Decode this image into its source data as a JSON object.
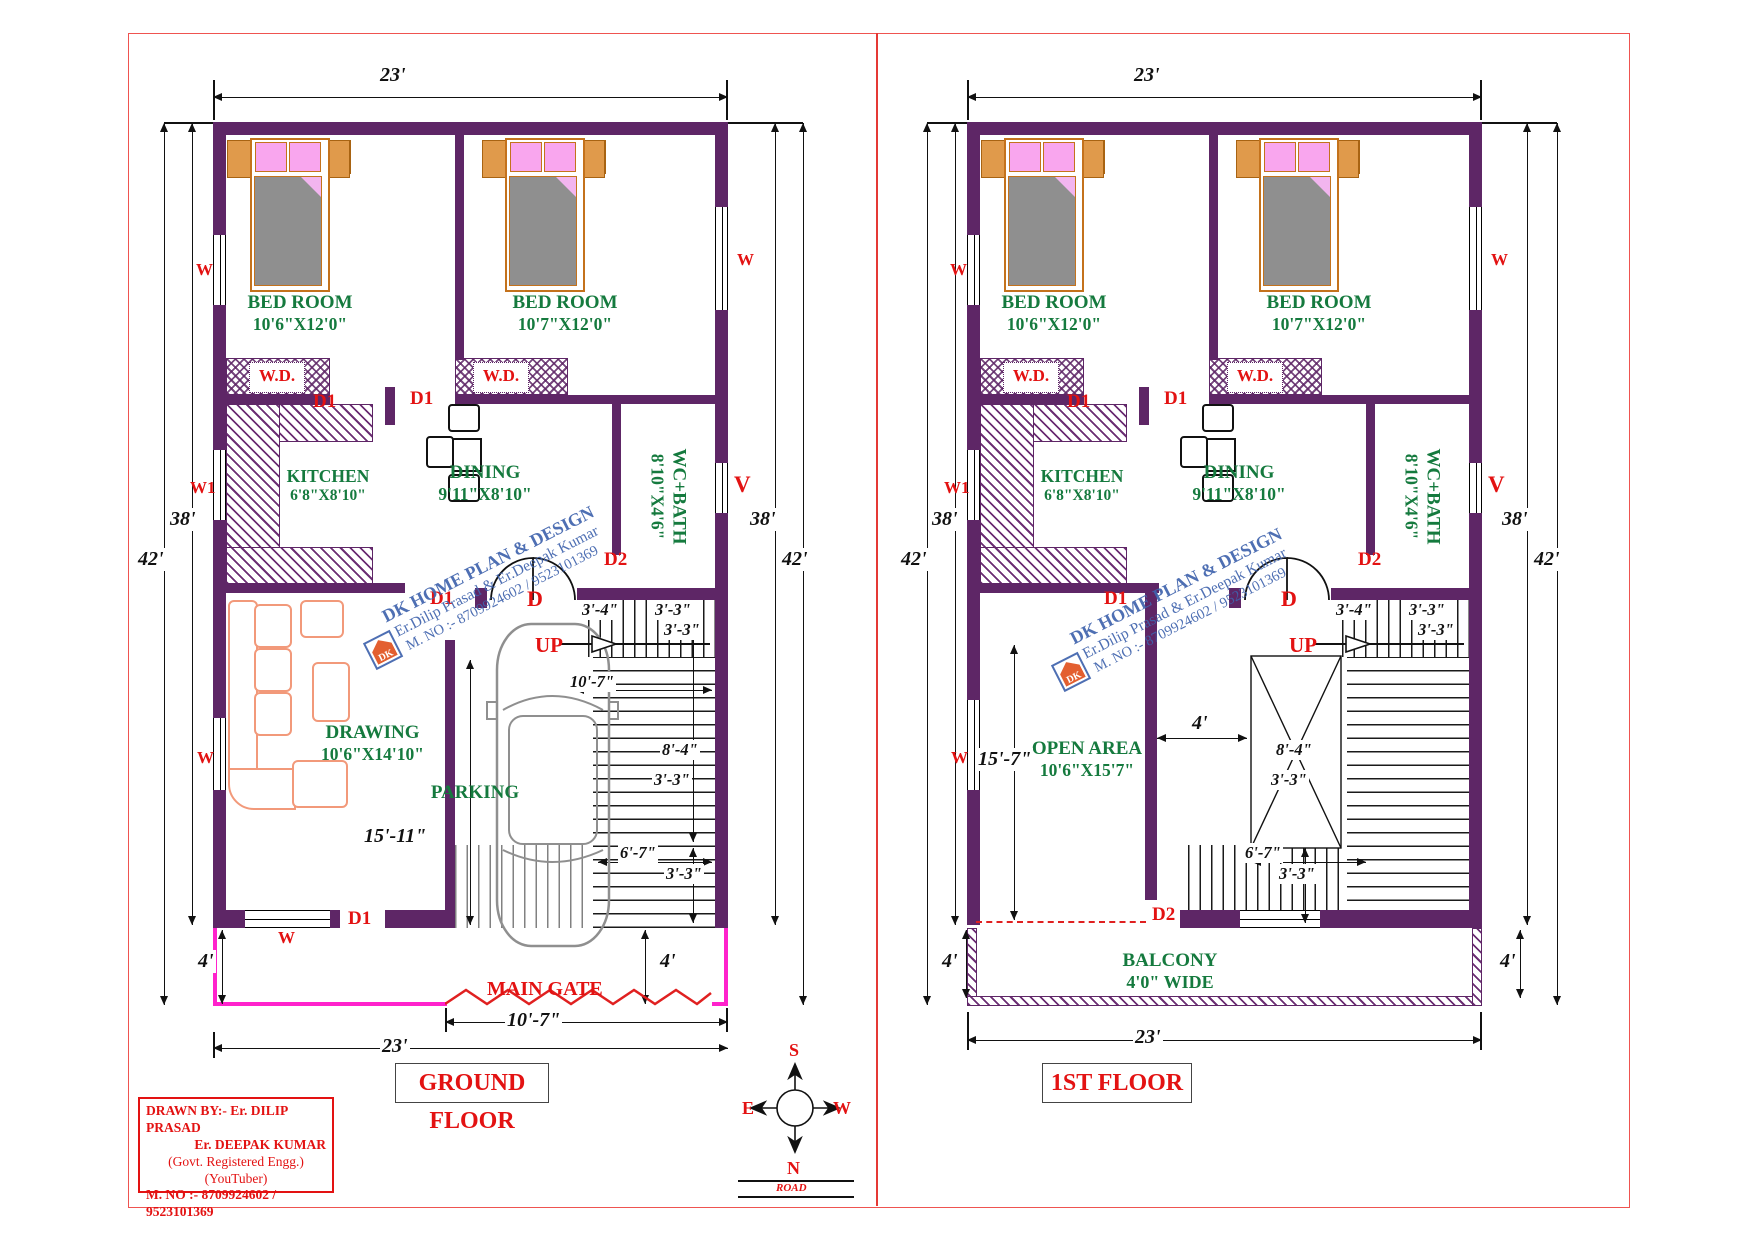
{
  "sheet": {
    "border_color": "#ef5350"
  },
  "compass": {
    "n": "N",
    "s": "S",
    "e": "E",
    "w": "W",
    "road": "ROAD"
  },
  "title_block": {
    "drawn_by": "DRAWN BY:- Er. DILIP PRASAD",
    "author2": "Er. DEEPAK KUMAR",
    "reg": "(Govt. Registered Engg.)",
    "yt": "(YouTuber)",
    "phone": "M. NO :- 8709924602 / 9523101369"
  },
  "watermark": {
    "logo": "DK",
    "brand": "DK HOME PLAN & DESIGN",
    "authors": "Er.Dilip Prasad & Er.Deepak Kumar",
    "phone": "M. NO :- 8709924602 / 9523101369"
  },
  "labels": {
    "d1": "D1",
    "d2": "D2",
    "d": "D",
    "up": "UP",
    "w": "W",
    "w1": "W1",
    "v": "V",
    "main_gate": "MAIN GATE"
  },
  "dims": {
    "w23": "23'",
    "h38": "38'",
    "h42": "42'",
    "p4": "4'",
    "g107": "10'-7\"",
    "s34": "3'-4\"",
    "s33": "3'-3\"",
    "s84": "8'-4\"",
    "s67": "6'-7\"",
    "p1511": "15'-11\"",
    "o157": "15'-7\"",
    "pass4": "4'"
  },
  "g": {
    "title": "GROUND FLOOR",
    "bed1_name": "BED ROOM",
    "bed1_size": "10'6\"X12'0\"",
    "bed2_name": "BED ROOM",
    "bed2_size": "10'7\"X12'0\"",
    "wd": "W.D.",
    "kitchen_name": "KITCHEN",
    "kitchen_size": "6'8\"X8'10\"",
    "dining_name": "DINING",
    "dining_size": "9'11\"X8'10\"",
    "wc_name": "WC+BATH",
    "wc_size": "8'10\"X4'6\"",
    "drawing_name": "DRAWING",
    "drawing_size": "10'6\"X14'10\"",
    "parking": "PARKING"
  },
  "f": {
    "title": "1ST FLOOR",
    "bed1_name": "BED ROOM",
    "bed1_size": "10'6\"X12'0\"",
    "bed2_name": "BED ROOM",
    "bed2_size": "10'7\"X12'0\"",
    "wd": "W.D.",
    "kitchen_name": "KITCHEN",
    "kitchen_size": "6'8\"X8'10\"",
    "dining_name": "DINING",
    "dining_size": "9'11\"X8'10\"",
    "wc_name": "WC+BATH",
    "wc_size": "8'10\"X4'6\"",
    "open_name": "OPEN AREA",
    "open_size": "10'6\"X15'7\"",
    "balcony_name": "BALCONY",
    "balcony_size": "4'0\" WIDE"
  }
}
